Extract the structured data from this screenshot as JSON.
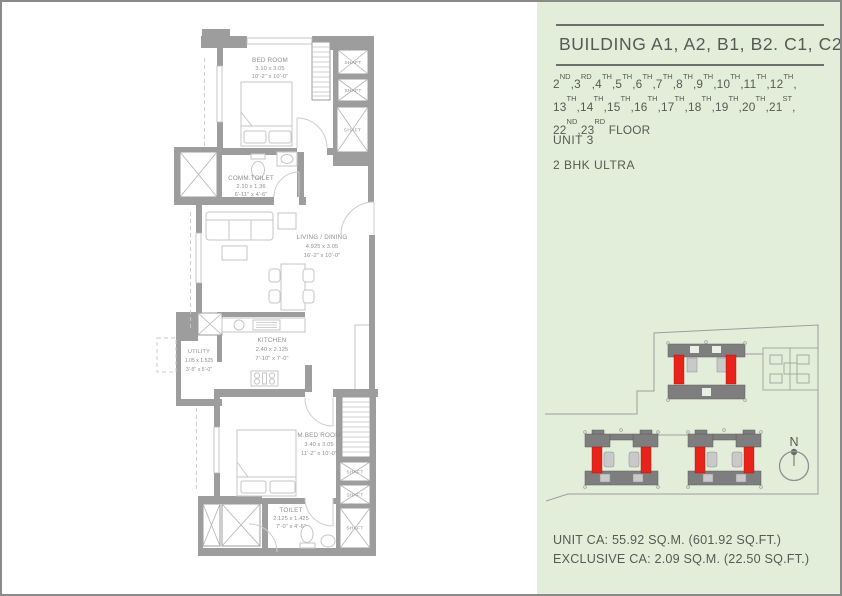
{
  "colors": {
    "page_bg": "#ffffff",
    "page_border": "#8a8a8a",
    "panel_bg": "#e3eeda",
    "text_dark": "#545b54",
    "rule": "#6e6e6e",
    "wall": "#9d9d9d",
    "fixture_line": "#c6c6c6",
    "plan_text": "#8f8f8f",
    "highlight_red": "#e8231a",
    "site_gray": "#7e7e7e"
  },
  "info_panel": {
    "title": "BUILDING A1, A2, B1, B2. C1, C2",
    "floor_lines": [
      [
        "2ND",
        "3RD",
        "4TH",
        "5TH",
        "6TH",
        "7TH",
        "8TH",
        "9TH",
        "10TH",
        "11TH",
        "12TH"
      ],
      [
        "13TH",
        "14TH",
        "15TH",
        "16TH",
        "17TH",
        "18TH",
        "19TH",
        "20TH",
        "21ST"
      ],
      [
        "22ND",
        "23RD"
      ]
    ],
    "floor_word": "FLOOR",
    "unit": "UNIT 3",
    "unit_type": "2 BHK ULTRA",
    "unit_ca": "UNIT CA: 55.92 SQ.M. (601.92 SQ.FT.)",
    "exclusive_ca": "EXCLUSIVE CA: 2.09 SQ.M. (22.50 SQ.FT.)"
  },
  "floor_plan": {
    "rooms": {
      "bedroom": {
        "name": "BED ROOM",
        "metric": "3.10 x 3.05",
        "imperial": "10'-2\" x 10'-0\""
      },
      "comm_toilet": {
        "name": "COMM.TOILET",
        "metric": "2.10 x 1.36",
        "imperial": "6'-11\" x 4'-6\""
      },
      "living_dining": {
        "name": "LIVING / DINING",
        "metric": "4.925 x 3.05",
        "imperial": "16'-2\" x 10'-0\""
      },
      "kitchen": {
        "name": "KITCHEN",
        "metric": "2.40 x 2.125",
        "imperial": "7'-10\" x 7'-0\""
      },
      "utility": {
        "name": "UTILITY",
        "metric": "1.05 x 1.525",
        "imperial": "3'-5\" x 5'-0\""
      },
      "master_bedroom": {
        "name": "M.BED ROOM",
        "metric": "3.40 x 3.05",
        "imperial": "11'-2\" x 10'-0\""
      },
      "toilet": {
        "name": "TOILET",
        "metric": "2.125 x 1.425",
        "imperial": "7'-0\" x 4'-6\""
      }
    },
    "shaft_label": "SHAFT"
  },
  "site_plan": {
    "north_label": "N"
  }
}
